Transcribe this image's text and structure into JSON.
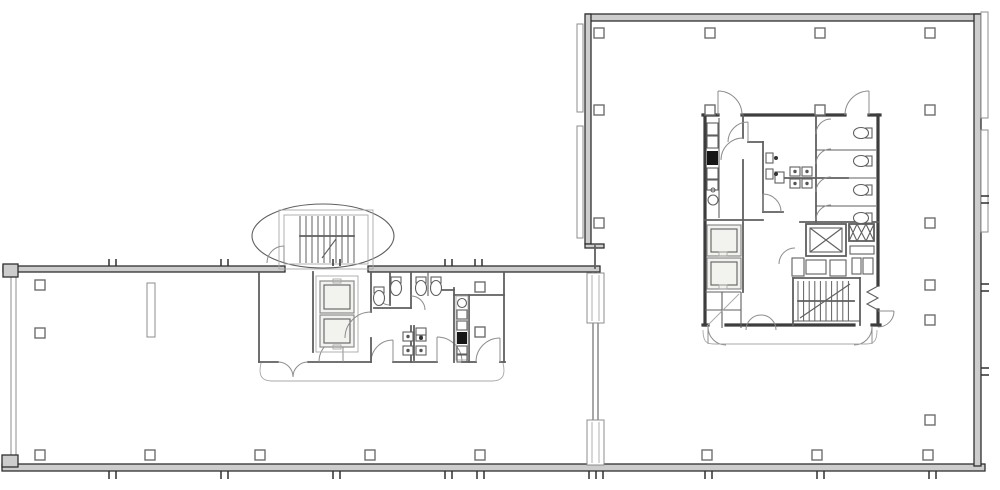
{
  "meta": {
    "title": "architectural-floor-plan",
    "description": "Black-and-white CAD floor plan of an office building: long low wing at left joined to a large square tower plate at right, each with a service core (stairs, elevators, restrooms, kitchenette).",
    "visible_text": [],
    "areas": [
      "open-floor-left-wing",
      "open-floor-right-tower",
      "oval-stair-tower",
      "left-core-elevators",
      "left-core-restroom",
      "left-core-kitchenette",
      "right-core-kitchenette",
      "right-core-restroom",
      "right-core-elevators",
      "right-core-service-shaft",
      "right-core-stair"
    ]
  },
  "colors": {
    "background": "#ffffff",
    "wall_dark": "#2f2f2f",
    "wall_fill": "#cdcdcd",
    "line_strong": "#3d3d3d",
    "line_medium": "#5f5f5f",
    "line_light": "#8c8c8c",
    "line_faint": "#a8a8a8",
    "fixture_dark": "#161616",
    "cab_fill": "#f2f2ee",
    "column_stroke": "#6e6e6e"
  },
  "columns": {
    "size": 10,
    "centers": [
      [
        599,
        33
      ],
      [
        710,
        33
      ],
      [
        820,
        33
      ],
      [
        930,
        33
      ],
      [
        599,
        110
      ],
      [
        710,
        110
      ],
      [
        820,
        110
      ],
      [
        930,
        110
      ],
      [
        599,
        223
      ],
      [
        930,
        223
      ],
      [
        930,
        285
      ],
      [
        930,
        320
      ],
      [
        930,
        420
      ],
      [
        40,
        285
      ],
      [
        40,
        333
      ],
      [
        480,
        287
      ],
      [
        480,
        332
      ],
      [
        40,
        455
      ],
      [
        150,
        455
      ],
      [
        260,
        455
      ],
      [
        370,
        455
      ],
      [
        480,
        455
      ],
      [
        707,
        455
      ],
      [
        817,
        455
      ],
      [
        928,
        455
      ]
    ]
  },
  "window_ticks": {
    "pair_gap": 7,
    "top_wall_x": [
      109,
      221,
      333,
      445,
      475
    ],
    "bottom_wall_x": [
      109,
      221,
      333,
      445,
      477,
      705,
      817,
      929
    ],
    "bottom_wall_singles_x": [
      589,
      596,
      603
    ],
    "right_wall_y": [
      196,
      203,
      284,
      291,
      368,
      375
    ]
  },
  "stairs": [
    {
      "name": "left-wing-stair",
      "x1": 300,
      "x2": 354,
      "step": 6,
      "y1": 216,
      "y2": 263
    },
    {
      "name": "right-core-stair",
      "x1": 798,
      "x2": 854,
      "step": 5.6,
      "y1": 281,
      "y2": 321
    }
  ],
  "fixtures": {
    "toilets": [
      {
        "x": 379,
        "y": 297,
        "rot": 0
      },
      {
        "x": 396,
        "y": 287,
        "rot": 0
      },
      {
        "x": 421,
        "y": 287,
        "rot": 0
      },
      {
        "x": 436,
        "y": 287,
        "rot": 0
      },
      {
        "x": 862,
        "y": 133,
        "rot": 90
      },
      {
        "x": 862,
        "y": 161,
        "rot": 90
      },
      {
        "x": 862,
        "y": 190,
        "rot": 90
      },
      {
        "x": 862,
        "y": 218,
        "rot": 90
      }
    ],
    "sinks": [
      [
        403,
        332
      ],
      [
        416,
        332
      ],
      [
        403,
        346
      ],
      [
        416,
        346
      ],
      [
        790,
        167
      ],
      [
        802,
        167
      ],
      [
        790,
        179
      ],
      [
        802,
        179
      ]
    ],
    "urinals": [
      {
        "x": 766,
        "y": 158,
        "rot": 0
      },
      {
        "x": 766,
        "y": 174,
        "rot": 0
      },
      {
        "x": 421,
        "y": 328,
        "rot": 90
      }
    ]
  }
}
